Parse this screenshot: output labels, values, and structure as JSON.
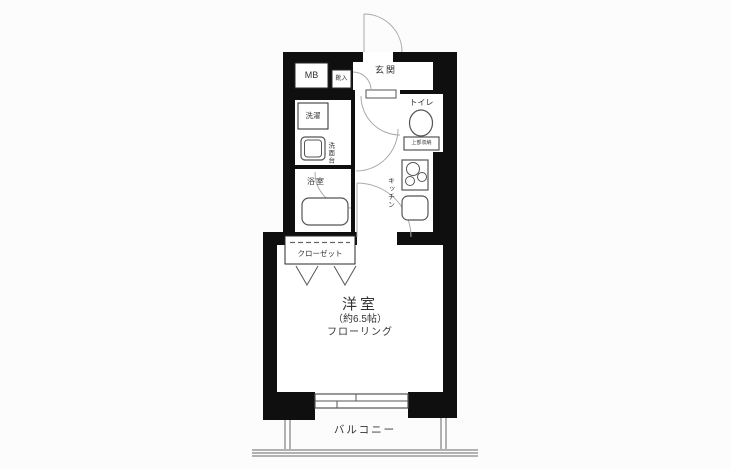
{
  "colors": {
    "bg": "#fcfcfc",
    "wall": "#0f0f0f",
    "room": "#ffffff",
    "line": "#555555",
    "arc": "#aaaaaa",
    "text": "#333333"
  },
  "rooms": {
    "entrance": "玄関",
    "meter_box": "MB",
    "shoe_cabinet": "靴入",
    "toilet": "トイレ",
    "toilet_storage": "上部収納",
    "laundry": "洗濯",
    "washstand": "洗面台",
    "bathroom": "浴室",
    "kitchen": "キッチン",
    "closet": "クローゼット",
    "main_room": "洋室",
    "main_room_size": "（約6.5帖）",
    "main_room_floor": "フローリング",
    "balcony": "バルコニー"
  }
}
